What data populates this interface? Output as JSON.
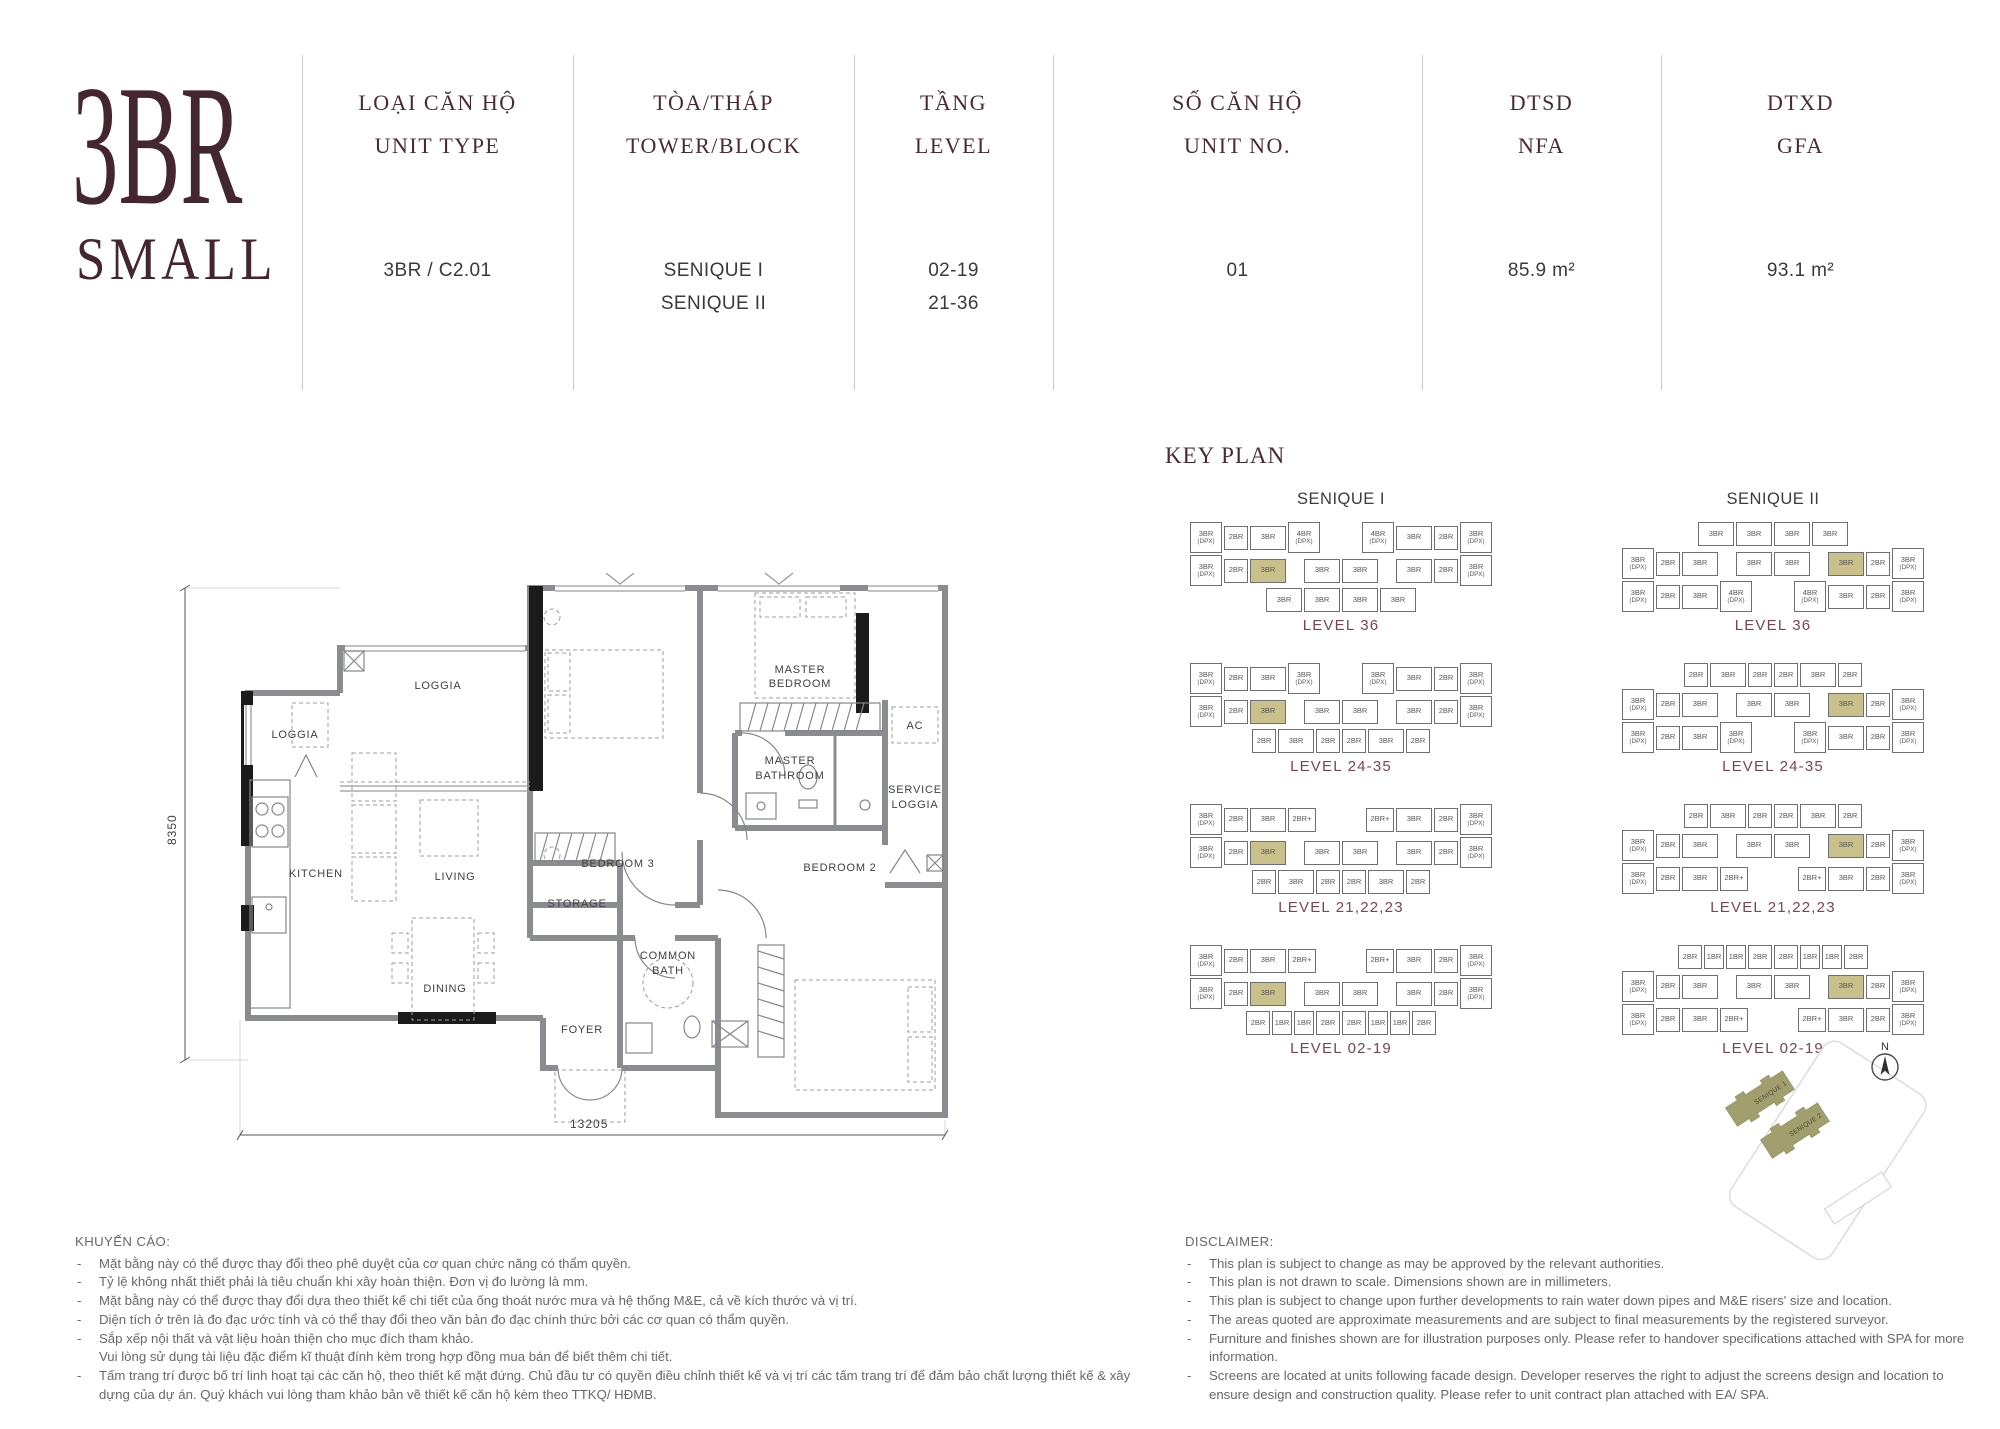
{
  "colors": {
    "accent_maroon": "#44262e",
    "header_maroon": "#4a2a35",
    "level_label": "#7c4550",
    "unit_highlight": "#c9c08c",
    "site_building_olive": "#a29f6f",
    "text_gray": "#66686c"
  },
  "logo": {
    "line1": "3BR",
    "line2": "SMALL"
  },
  "header": {
    "columns": [
      {
        "label_vi": "LOẠI CĂN HỘ",
        "label_en": "UNIT TYPE",
        "value1": "3BR / C2.01",
        "value2": ""
      },
      {
        "label_vi": "TÒA/THÁP",
        "label_en": "TOWER/BLOCK",
        "value1": "SENIQUE I",
        "value2": "SENIQUE II"
      },
      {
        "label_vi": "TẦNG",
        "label_en": "LEVEL",
        "value1": "02-19",
        "value2": "21-36"
      },
      {
        "label_vi": "SỐ CĂN HỘ",
        "label_en": "UNIT NO.",
        "value1": "01",
        "value2": ""
      },
      {
        "label_vi": "DTSD",
        "label_en": "NFA",
        "value1": "85.9 m²",
        "value2": ""
      },
      {
        "label_vi": "DTXD",
        "label_en": "GFA",
        "value1": "93.1 m²",
        "value2": ""
      }
    ]
  },
  "floorplan": {
    "rooms": {
      "loggia_top": "LOGGIA",
      "loggia_left": "LOGGIA",
      "kitchen": "KITCHEN",
      "living": "LIVING",
      "dining": "DINING",
      "foyer": "FOYER",
      "storage": "STORAGE",
      "bedroom3": "BEDROOM 3",
      "master1": "MASTER",
      "master2": "BEDROOM",
      "mbath1": "MASTER",
      "mbath2": "BATHROOM",
      "ac": "AC",
      "service1": "SERVICE",
      "service2": "LOGGIA",
      "bedroom2": "BEDROOM 2",
      "cbath1": "COMMON",
      "cbath2": "BATH"
    },
    "dim_height": "8350",
    "dim_width": "13205"
  },
  "keyplan": {
    "title": "KEY PLAN",
    "towers": [
      {
        "name": "SENIQUE I",
        "levels": [
          {
            "label": "LEVEL 36",
            "rows": [
              [
                "3BR(DPX)",
                "2BR",
                "3BR",
                "4BR(DPX)",
                "|",
                "4BR(DPX)",
                "3BR",
                "2BR",
                "3BR(DPX)"
              ],
              [
                "3BR(DPX)",
                "2BR",
                "3BR*",
                "|",
                "3BR",
                "3BR",
                "|",
                "3BR",
                "2BR",
                "3BR(DPX)"
              ],
              [
                "|",
                "3BR",
                "3BR",
                "3BR",
                "3BR",
                "|"
              ]
            ]
          },
          {
            "label": "LEVEL 24-35",
            "rows": [
              [
                "3BR(DPX)",
                "2BR",
                "3BR",
                "3BR(DPX)",
                "|",
                "3BR(DPX)",
                "3BR",
                "2BR",
                "3BR(DPX)"
              ],
              [
                "3BR(DPX)",
                "2BR",
                "3BR*",
                "|",
                "3BR",
                "3BR",
                "|",
                "3BR",
                "2BR",
                "3BR(DPX)"
              ],
              [
                "|",
                "2BR",
                "3BR",
                "2BR",
                "2BR",
                "3BR",
                "2BR",
                "|"
              ]
            ]
          },
          {
            "label": "LEVEL 21,22,23",
            "rows": [
              [
                "3BR(DPX)",
                "2BR",
                "3BR",
                "2BR+",
                "|",
                "2BR+",
                "3BR",
                "2BR",
                "3BR(DPX)"
              ],
              [
                "3BR(DPX)",
                "2BR",
                "3BR*",
                "|",
                "3BR",
                "3BR",
                "|",
                "3BR",
                "2BR",
                "3BR(DPX)"
              ],
              [
                "|",
                "2BR",
                "3BR",
                "2BR",
                "2BR",
                "3BR",
                "2BR",
                "|"
              ]
            ]
          },
          {
            "label": "LEVEL 02-19",
            "rows": [
              [
                "3BR(DPX)",
                "2BR",
                "3BR",
                "2BR+",
                "|",
                "2BR+",
                "3BR",
                "2BR",
                "3BR(DPX)"
              ],
              [
                "3BR(DPX)",
                "2BR",
                "3BR*",
                "|",
                "3BR",
                "3BR",
                "|",
                "3BR",
                "2BR",
                "3BR(DPX)"
              ],
              [
                "|",
                "2BR",
                "1BR",
                "1BR",
                "2BR",
                "2BR",
                "1BR",
                "1BR",
                "2BR",
                "|"
              ]
            ]
          }
        ]
      },
      {
        "name": "SENIQUE II",
        "levels": [
          {
            "label": "LEVEL 36",
            "rows": [
              [
                "|",
                "3BR",
                "3BR",
                "3BR",
                "3BR",
                "|"
              ],
              [
                "3BR(DPX)",
                "2BR",
                "3BR",
                "|",
                "3BR",
                "3BR",
                "|",
                "3BR*",
                "2BR",
                "3BR(DPX)"
              ],
              [
                "3BR(DPX)",
                "2BR",
                "3BR",
                "4BR(DPX)",
                "|",
                "4BR(DPX)",
                "3BR",
                "2BR",
                "3BR(DPX)"
              ]
            ]
          },
          {
            "label": "LEVEL 24-35",
            "rows": [
              [
                "|",
                "2BR",
                "3BR",
                "2BR",
                "2BR",
                "3BR",
                "2BR",
                "|"
              ],
              [
                "3BR(DPX)",
                "2BR",
                "3BR",
                "|",
                "3BR",
                "3BR",
                "|",
                "3BR*",
                "2BR",
                "3BR(DPX)"
              ],
              [
                "3BR(DPX)",
                "2BR",
                "3BR",
                "3BR(DPX)",
                "|",
                "3BR(DPX)",
                "3BR",
                "2BR",
                "3BR(DPX)"
              ]
            ]
          },
          {
            "label": "LEVEL 21,22,23",
            "rows": [
              [
                "|",
                "2BR",
                "3BR",
                "2BR",
                "2BR",
                "3BR",
                "2BR",
                "|"
              ],
              [
                "3BR(DPX)",
                "2BR",
                "3BR",
                "|",
                "3BR",
                "3BR",
                "|",
                "3BR*",
                "2BR",
                "3BR(DPX)"
              ],
              [
                "3BR(DPX)",
                "2BR",
                "3BR",
                "2BR+",
                "|",
                "2BR+",
                "3BR",
                "2BR",
                "3BR(DPX)"
              ]
            ]
          },
          {
            "label": "LEVEL 02-19",
            "rows": [
              [
                "|",
                "2BR",
                "1BR",
                "1BR",
                "2BR",
                "2BR",
                "1BR",
                "1BR",
                "2BR",
                "|"
              ],
              [
                "3BR(DPX)",
                "2BR",
                "3BR",
                "|",
                "3BR",
                "3BR",
                "|",
                "3BR*",
                "2BR",
                "3BR(DPX)"
              ],
              [
                "3BR(DPX)",
                "2BR",
                "3BR",
                "2BR+",
                "|",
                "2BR+",
                "3BR",
                "2BR",
                "3BR(DPX)"
              ]
            ]
          }
        ]
      }
    ]
  },
  "siteplan": {
    "north": "N",
    "buildings": [
      "SENIQUE 1",
      "SENIQUE 2"
    ]
  },
  "notes_vi": {
    "heading": "KHUYẾN CÁO:",
    "items": [
      {
        "d": "-",
        "t": "Mặt bằng này có thể được thay đổi theo phê duyệt của cơ quan chức năng có thẩm quyền."
      },
      {
        "d": "-",
        "t": "Tỷ lệ không nhất thiết phải là tiêu chuẩn khi xây hoàn thiện. Đơn vị đo lường là mm."
      },
      {
        "d": "-",
        "t": "Mặt bằng này có thể được thay đổi dựa theo thiết kế chi tiết của ống thoát nước mưa và hệ thống M&E, cả về kích thước và vị trí."
      },
      {
        "d": "-",
        "t": "Diện tích ở trên là đo đạc ước tính và có thể thay đổi theo văn bản đo đạc chính thức bởi các cơ quan có thẩm quyền."
      },
      {
        "d": "-",
        "t": "Sắp xếp nội thất và vật liệu hoàn thiện cho mục đích tham khảo."
      },
      {
        "d": "",
        "t": "Vui lòng sử dụng tài liệu đặc điểm kĩ thuật đính kèm trong hợp đồng mua bán để biết thêm chi tiết."
      },
      {
        "d": "-",
        "t": "Tấm trang trí được bố trí linh hoạt tại các căn hộ, theo thiết kế mặt đứng. Chủ đầu tư có quyền điều chỉnh thiết kế và vị trí các tấm trang trí để đảm bảo chất lượng thiết kế & xây dựng của dự án. Quý khách vui lòng tham khảo bản vẽ thiết kế căn hộ kèm theo TTKQ/ HĐMB."
      }
    ]
  },
  "notes_en": {
    "heading": "DISCLAIMER:",
    "items": [
      {
        "d": "-",
        "t": "This plan is subject to change as may be approved by the relevant authorities."
      },
      {
        "d": "-",
        "t": "This plan is not drawn to scale. Dimensions shown are in millimeters."
      },
      {
        "d": "-",
        "t": "This plan is subject to change upon further developments to rain water down pipes and M&E risers' size and location."
      },
      {
        "d": "-",
        "t": "The areas quoted are approximate measurements and are subject to final measurements by the registered surveyor."
      },
      {
        "d": "-",
        "t": "Furniture and finishes shown are for illustration purposes only. Please refer to handover specifications attached with SPA for more information."
      },
      {
        "d": "-",
        "t": "Screens are located at units following facade design. Developer reserves the right to adjust the screens design and location to ensure design and construction quality. Please refer to unit contract plan attached with EA/ SPA."
      }
    ]
  }
}
